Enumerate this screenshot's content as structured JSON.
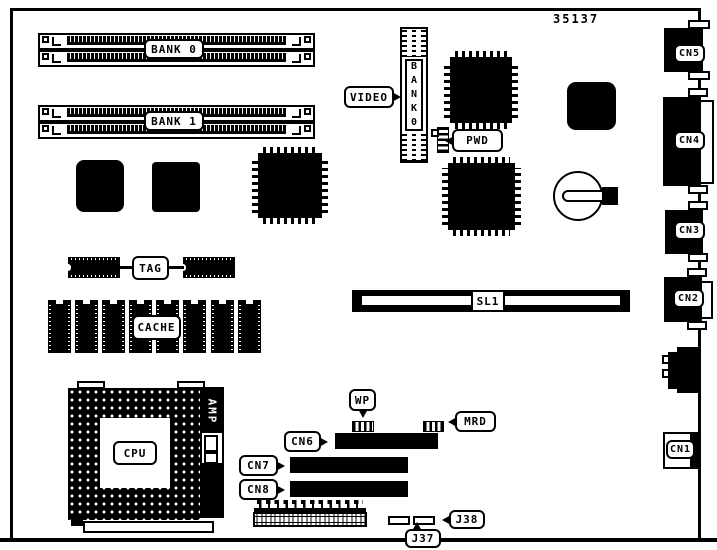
{
  "part_number": "35137",
  "labels": {
    "bank0": "BANK 0",
    "bank1": "BANK 1",
    "video": "VIDEO",
    "video_slot_text": "BANK0",
    "pwd": "PWD",
    "tag": "TAG",
    "cache": "CACHE",
    "sl1": "SL1",
    "cpu": "CPU",
    "amp": "AMP",
    "wp": "WP",
    "mrd": "MRD",
    "cn6": "CN6",
    "cn7": "CN7",
    "cn8": "CN8",
    "j37": "J37",
    "j38": "J38",
    "cn5": "CN5",
    "cn4": "CN4",
    "cn3": "CN3",
    "cn2": "CN2",
    "cn1": "CN1"
  }
}
